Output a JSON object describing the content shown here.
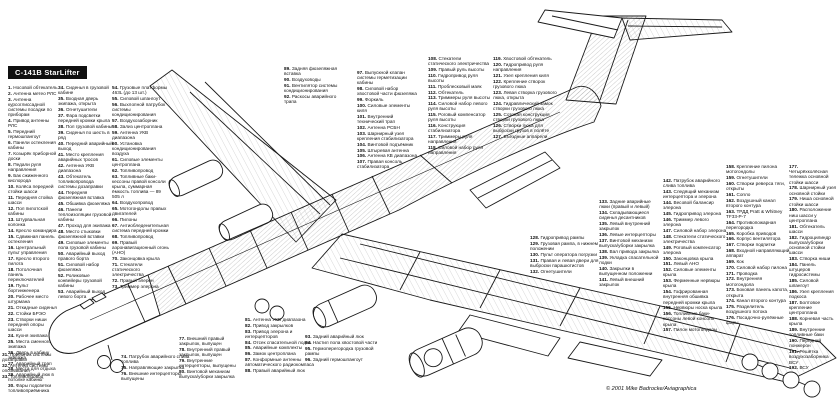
{
  "title": "C-141B StarLifter",
  "copyright": "© 2001 Mike Badrocke/Aviagraphica",
  "colors": {
    "ink": "#1a1a1a",
    "paper": "#ffffff",
    "title_bg": "#101010",
    "title_fg": "#ffffff"
  },
  "legend": {
    "c1": {
      "items": [
        {
          "n": "1",
          "t": "Носовой обтекатель"
        },
        {
          "n": "2",
          "t": "Антенна метео РЛС"
        },
        {
          "n": "3",
          "t": "Антенна курсоглиссадной системы посадки по приборам"
        },
        {
          "n": "4",
          "t": "Привод антенны РЛС"
        },
        {
          "n": "5",
          "t": "Передний гермошпангоут"
        },
        {
          "n": "6",
          "t": "Панели остекления кабины"
        },
        {
          "n": "7",
          "t": "Козырёк приборной доски"
        },
        {
          "n": "8",
          "t": "Педали руля направления"
        },
        {
          "n": "9",
          "t": "Бак сжиженного кислорода"
        },
        {
          "n": "10",
          "t": "Колёса передней стойки шасси"
        },
        {
          "n": "11",
          "t": "Передняя стойка шасси"
        },
        {
          "n": "12",
          "t": "Пол пилотской кабины"
        },
        {
          "n": "13",
          "t": "Штурвальная колонка"
        },
        {
          "n": "14",
          "t": "Кресло командира"
        },
        {
          "n": "15",
          "t": "Сдвижная панель остекления"
        },
        {
          "n": "16",
          "t": "Центральный пульт управления"
        },
        {
          "n": "17",
          "t": "Кресло второго пилота"
        },
        {
          "n": "18",
          "t": "Потолочная панель переключателей"
        },
        {
          "n": "19",
          "t": "Пульт бортинженера"
        },
        {
          "n": "20",
          "t": "Рабочее место штурмана"
        },
        {
          "n": "21",
          "t": "Откидные сиденья"
        },
        {
          "n": "22",
          "t": "Стойки БРЭО"
        },
        {
          "n": "23",
          "t": "Створки ниши передней опоры шасси"
        },
        {
          "n": "24",
          "t": "Кухня экипажа"
        },
        {
          "n": "25",
          "t": "Места сменного экипажа"
        },
        {
          "n": "26",
          "t": "Дверь в кабину экипажа"
        },
        {
          "n": "27",
          "t": "Аварийный трап"
        },
        {
          "n": "28",
          "t": "Места для отдыха"
        },
        {
          "n": "29",
          "t": "Аварийный люк в потолке кабины"
        },
        {
          "n": "30",
          "t": "Фары подсветки топливоприёмника"
        }
      ]
    },
    "c1b": {
      "items": [
        {
          "n": "31",
          "t": "Приёмник системы дозаправки"
        },
        {
          "n": "32",
          "t": "Антенна системы опознавания"
        },
        {
          "n": "33",
          "t": "Топливопровод"
        }
      ]
    },
    "c2": {
      "items": [
        {
          "n": "34",
          "t": "Сиденья в грузовой кабине"
        },
        {
          "n": "35",
          "t": "Входная дверь экипажа, открыта"
        },
        {
          "n": "36",
          "t": "Огнетушители"
        },
        {
          "n": "37",
          "t": "Фара подсветки передней кромки крыла"
        },
        {
          "n": "38",
          "t": "Пол грузовой кабины"
        },
        {
          "n": "39",
          "t": "Сиденья по шесть в ряд"
        },
        {
          "n": "40",
          "t": "Передний аварийный выход"
        },
        {
          "n": "41",
          "t": "Место крепления аварийных тросов"
        },
        {
          "n": "42",
          "t": "Антенна УКВ диапазона"
        },
        {
          "n": "43",
          "t": "Обтекатель топливопровода системы дозаправки"
        },
        {
          "n": "44",
          "t": "Передняя фюзеляжная вставка"
        },
        {
          "n": "45",
          "t": "Обшивка фюзеляжа"
        },
        {
          "n": "46",
          "t": "Панели теплоизоляции грузовой кабины"
        },
        {
          "n": "47",
          "t": "Проход для экипажа"
        },
        {
          "n": "48",
          "t": "Место стыковки фюзеляжной вставки"
        },
        {
          "n": "49",
          "t": "Силовые элементы пола грузовой кабины"
        },
        {
          "n": "50",
          "t": "Аварийный выход правого борта"
        },
        {
          "n": "51",
          "t": "Силовой набор фюзеляжа"
        },
        {
          "n": "52",
          "t": "Роликовые конвейеры грузовой кабины"
        },
        {
          "n": "53",
          "t": "Аварийный выход левого борта"
        }
      ]
    },
    "c3": {
      "items": [
        {
          "n": "54",
          "t": "Грузовые платформы 463L (до 13 шт.)"
        },
        {
          "n": "55",
          "t": "Силовой шпангоут"
        },
        {
          "n": "56",
          "t": "Выхлопной патрубок системы кондиционирования"
        },
        {
          "n": "57",
          "t": "Воздухозаборник"
        },
        {
          "n": "58",
          "t": "Зализ центроплана"
        },
        {
          "n": "59",
          "t": "Антенна УКВ диапазона"
        },
        {
          "n": "60",
          "t": "Установка кондиционирования воздуха"
        },
        {
          "n": "61",
          "t": "Силовые элементы центроплана"
        },
        {
          "n": "62",
          "t": "Топливопровод"
        },
        {
          "n": "63",
          "t": "Топливные баки-кессоны правой консоли крыла, суммарная ёмкость топлива — 89 505 л"
        },
        {
          "n": "64",
          "t": "Воздухопровод"
        },
        {
          "n": "65",
          "t": "Мотогондолы правых двигателей"
        },
        {
          "n": "66",
          "t": "Пилоны"
        },
        {
          "n": "67",
          "t": "Антиобледенительная система передней кромки"
        },
        {
          "n": "68",
          "t": "Топливопровод"
        },
        {
          "n": "69",
          "t": "Правый аэронавигационный огонь (АНО)"
        },
        {
          "n": "70",
          "t": "Законцовка крыла"
        },
        {
          "n": "71",
          "t": "Стекатели статического электричества"
        },
        {
          "n": "72",
          "t": "Правый элерон"
        },
        {
          "n": "73",
          "t": "Триммер элерона"
        }
      ]
    },
    "c8": {
      "items": [
        {
          "n": "74",
          "t": "Патрубок аварийного слива топлива"
        },
        {
          "n": "75",
          "t": "Направляющие закрылка"
        },
        {
          "n": "76",
          "t": "Внешние интерцепторы, выпущены"
        }
      ]
    },
    "c9": {
      "items": [
        {
          "n": "77",
          "t": "Внешний правый закрылок, выпущен"
        },
        {
          "n": "78",
          "t": "Внутренний правый закрылок, выпущен"
        },
        {
          "n": "79",
          "t": "Внутренние интерцепторы, выпущены"
        },
        {
          "n": "80",
          "t": "Винтовой механизм выпуска/уборки закрылка"
        }
      ]
    },
    "c10": {
      "items": [
        {
          "n": "81",
          "t": "Антенна УКВ диапазона"
        },
        {
          "n": "82",
          "t": "Привод закрылков"
        },
        {
          "n": "83",
          "t": "Привод элерона и интерцепторов"
        },
        {
          "n": "84",
          "t": "Отсек спасательной лодки"
        },
        {
          "n": "85",
          "t": "Аварийные комплекты"
        },
        {
          "n": "86",
          "t": "Замок центроплана"
        },
        {
          "n": "87",
          "t": "Конформные антенны автоматического радиокомпаса"
        },
        {
          "n": "88",
          "t": "Правый аварийный люк"
        }
      ]
    },
    "c4": {
      "items": [
        {
          "n": "89",
          "t": "Задняя фюзеляжная вставка"
        },
        {
          "n": "90",
          "t": "Воздуховоды"
        },
        {
          "n": "91",
          "t": "Вентилятор системы кондиционирования"
        },
        {
          "n": "92",
          "t": "Раскосы аварийного трапа"
        }
      ]
    },
    "c11": {
      "items": [
        {
          "n": "93",
          "t": "Задний аварийный люк"
        },
        {
          "n": "94",
          "t": "Настил пола хвостовой части"
        },
        {
          "n": "95",
          "t": "Гермоперегородка грузовой рампы"
        },
        {
          "n": "96",
          "t": "Задний гермошпангоут"
        }
      ]
    },
    "c5": {
      "items": [
        {
          "n": "97",
          "t": "Выпускной клапан системы герметизации кабины"
        },
        {
          "n": "98",
          "t": "Силовой набор хвостовой части фюзеляжа"
        },
        {
          "n": "99",
          "t": "Форкиль"
        },
        {
          "n": "100",
          "t": "Силовые элементы киля"
        },
        {
          "n": "101",
          "t": "Внутренний технический трап"
        },
        {
          "n": "102",
          "t": "Антенна РСБН"
        },
        {
          "n": "103",
          "t": "Шарнирный узел крепления стабилизатора"
        },
        {
          "n": "104",
          "t": "Винтовой подъёмник"
        },
        {
          "n": "105",
          "t": "Штыревая антенна"
        },
        {
          "n": "106",
          "t": "Антенна КВ диапазона"
        },
        {
          "n": "107",
          "t": "Правая консоль стабилизатора"
        }
      ]
    },
    "c6": {
      "items": [
        {
          "n": "108",
          "t": "Стекатели статического электричества"
        },
        {
          "n": "109",
          "t": "Правый руль высоты"
        },
        {
          "n": "110",
          "t": "Гидропривод руля высоты"
        },
        {
          "n": "111",
          "t": "Проблесковый маяк"
        },
        {
          "n": "112",
          "t": "Обтекатель"
        },
        {
          "n": "113",
          "t": "Триммеры руля высоты"
        },
        {
          "n": "114",
          "t": "Силовой набор левого руля высоты"
        },
        {
          "n": "115",
          "t": "Роговый компенсатор руля высоты"
        },
        {
          "n": "116",
          "t": "Конструкция стабилизатора"
        },
        {
          "n": "117",
          "t": "Триммеры руля направления"
        },
        {
          "n": "118",
          "t": "Силовой набор руля направления"
        }
      ]
    },
    "c7": {
      "items": [
        {
          "n": "119",
          "t": "Хвостовой обтекатель"
        },
        {
          "n": "120",
          "t": "Гидропривод руля направления"
        },
        {
          "n": "121",
          "t": "Узел крепления киля"
        },
        {
          "n": "122",
          "t": "Крепление створок грузового люка"
        },
        {
          "n": "123",
          "t": "Левая створка грузового люка, открыта"
        },
        {
          "n": "124",
          "t": "Гидравлический замок створки грузового люка"
        },
        {
          "n": "125",
          "t": "Сотовая конструкция створки грузового люка"
        },
        {
          "n": "126",
          "t": "Створки люка для выброски грузов в полёте"
        },
        {
          "n": "127",
          "t": "Въездные аппарели"
        }
      ]
    },
    "c12": {
      "items": [
        {
          "n": "128",
          "t": "Гидропривод рампы"
        },
        {
          "n": "129",
          "t": "Грузовая рампа, в нижнем положении"
        },
        {
          "n": "130",
          "t": "Пульт оператора погрузки"
        },
        {
          "n": "131",
          "t": "Правая и левая двери для выброски парашютистов"
        },
        {
          "n": "132",
          "t": "Огнетушители"
        }
      ]
    },
    "c13": {
      "items": [
        {
          "n": "133",
          "t": "Задние аварийные люки (правый и левый)"
        },
        {
          "n": "134",
          "t": "Складывающиеся сиденья десантников"
        },
        {
          "n": "135",
          "t": "Левый внутренний закрылок"
        },
        {
          "n": "136",
          "t": "Левые интерцепторы"
        },
        {
          "n": "137",
          "t": "Винтовой механизм выпуска/уборки закрылка"
        },
        {
          "n": "138",
          "t": "Вал привода закрылка"
        },
        {
          "n": "139",
          "t": "Укладка спасательной лодки"
        },
        {
          "n": "140",
          "t": "Закрылки в выпущенном положении"
        },
        {
          "n": "141",
          "t": "Левый внешний закрылок"
        }
      ]
    },
    "c14": {
      "items": [
        {
          "n": "142",
          "t": "Патрубок аварийного слива топлива"
        },
        {
          "n": "143",
          "t": "Следящий механизм интерцептора и элерона"
        },
        {
          "n": "144",
          "t": "Весовой балансир элерона"
        },
        {
          "n": "145",
          "t": "Гидропривод элерона"
        },
        {
          "n": "146",
          "t": "Триммер левого элерона"
        },
        {
          "n": "147",
          "t": "Силовой набор элерона"
        },
        {
          "n": "148",
          "t": "Стекатели статического электричества"
        },
        {
          "n": "149",
          "t": "Роговый компенсатор элерона"
        },
        {
          "n": "150",
          "t": "Законцовка крыла"
        },
        {
          "n": "151",
          "t": "Левый АНО"
        },
        {
          "n": "152",
          "t": "Силовые элементы крыла"
        },
        {
          "n": "153",
          "t": "Ферменные нервюры крыла"
        },
        {
          "n": "154",
          "t": "Гофрированная внутренняя обшивка передней кромки крыла"
        },
        {
          "n": "155",
          "t": "Нервюры носка крыла"
        },
        {
          "n": "156",
          "t": "Топливные баки-кессоны левой консоли крыла"
        },
        {
          "n": "157",
          "t": "Пилон мотогондолы"
        }
      ]
    },
    "c15": {
      "items": [
        {
          "n": "158",
          "t": "Крепление пилона мотогондолы"
        },
        {
          "n": "159",
          "t": "Огнетушители"
        },
        {
          "n": "160",
          "t": "Створки реверса тяги, открыты"
        },
        {
          "n": "161",
          "t": "Сопло"
        },
        {
          "n": "162",
          "t": "Воздушный канал второго контура"
        },
        {
          "n": "163",
          "t": "ТРДД Pratt & Whitney TF33-P-7"
        },
        {
          "n": "164",
          "t": "Противопожарная перегородка"
        },
        {
          "n": "165",
          "t": "Коробка приводов"
        },
        {
          "n": "166",
          "t": "Корпус вентилятора"
        },
        {
          "n": "167",
          "t": "Створки подпитки"
        },
        {
          "n": "168",
          "t": "Входной направляющий аппарат"
        },
        {
          "n": "169",
          "t": "Кок"
        },
        {
          "n": "170",
          "t": "Силовой набор пилона"
        },
        {
          "n": "171",
          "t": "Проводка"
        },
        {
          "n": "172",
          "t": "Внутренняя мотогондола"
        },
        {
          "n": "173",
          "t": "Боковая панель капота, открыта"
        },
        {
          "n": "174",
          "t": "Канал второго контура"
        },
        {
          "n": "175",
          "t": "Разделитель воздушного потока"
        },
        {
          "n": "176",
          "t": "Посадочно-рулёжные фары"
        }
      ]
    },
    "c16": {
      "items": [
        {
          "n": "177",
          "t": "Четырёхколёсная тележка основной стойки шасси"
        },
        {
          "n": "178",
          "t": "Шарнирный узел основной стойки"
        },
        {
          "n": "179",
          "t": "Ниша основной стойки шасси"
        },
        {
          "n": "180",
          "t": "Расположение ниш шасси у центроплана"
        },
        {
          "n": "181",
          "t": "Обтекатель шасси"
        },
        {
          "n": "182",
          "t": "Гидроцилиндр выпуска/уборки основной стойки шасси"
        },
        {
          "n": "183",
          "t": "Створка ниши"
        },
        {
          "n": "184",
          "t": "Панель штуцеров гидросистемы"
        },
        {
          "n": "185",
          "t": "Силовой шпангоут"
        },
        {
          "n": "186",
          "t": "Узел крепления подкоса"
        },
        {
          "n": "187",
          "t": "Болтовое крепление центроплана"
        },
        {
          "n": "188",
          "t": "Корневая часть крыла"
        },
        {
          "n": "189",
          "t": "Внутренние топливные баки"
        },
        {
          "n": "190",
          "t": "Передний лонжерон"
        },
        {
          "n": "191",
          "t": "Решётка воздухозаборника ВСУ"
        },
        {
          "n": "192",
          "t": "ВСУ"
        }
      ]
    }
  }
}
